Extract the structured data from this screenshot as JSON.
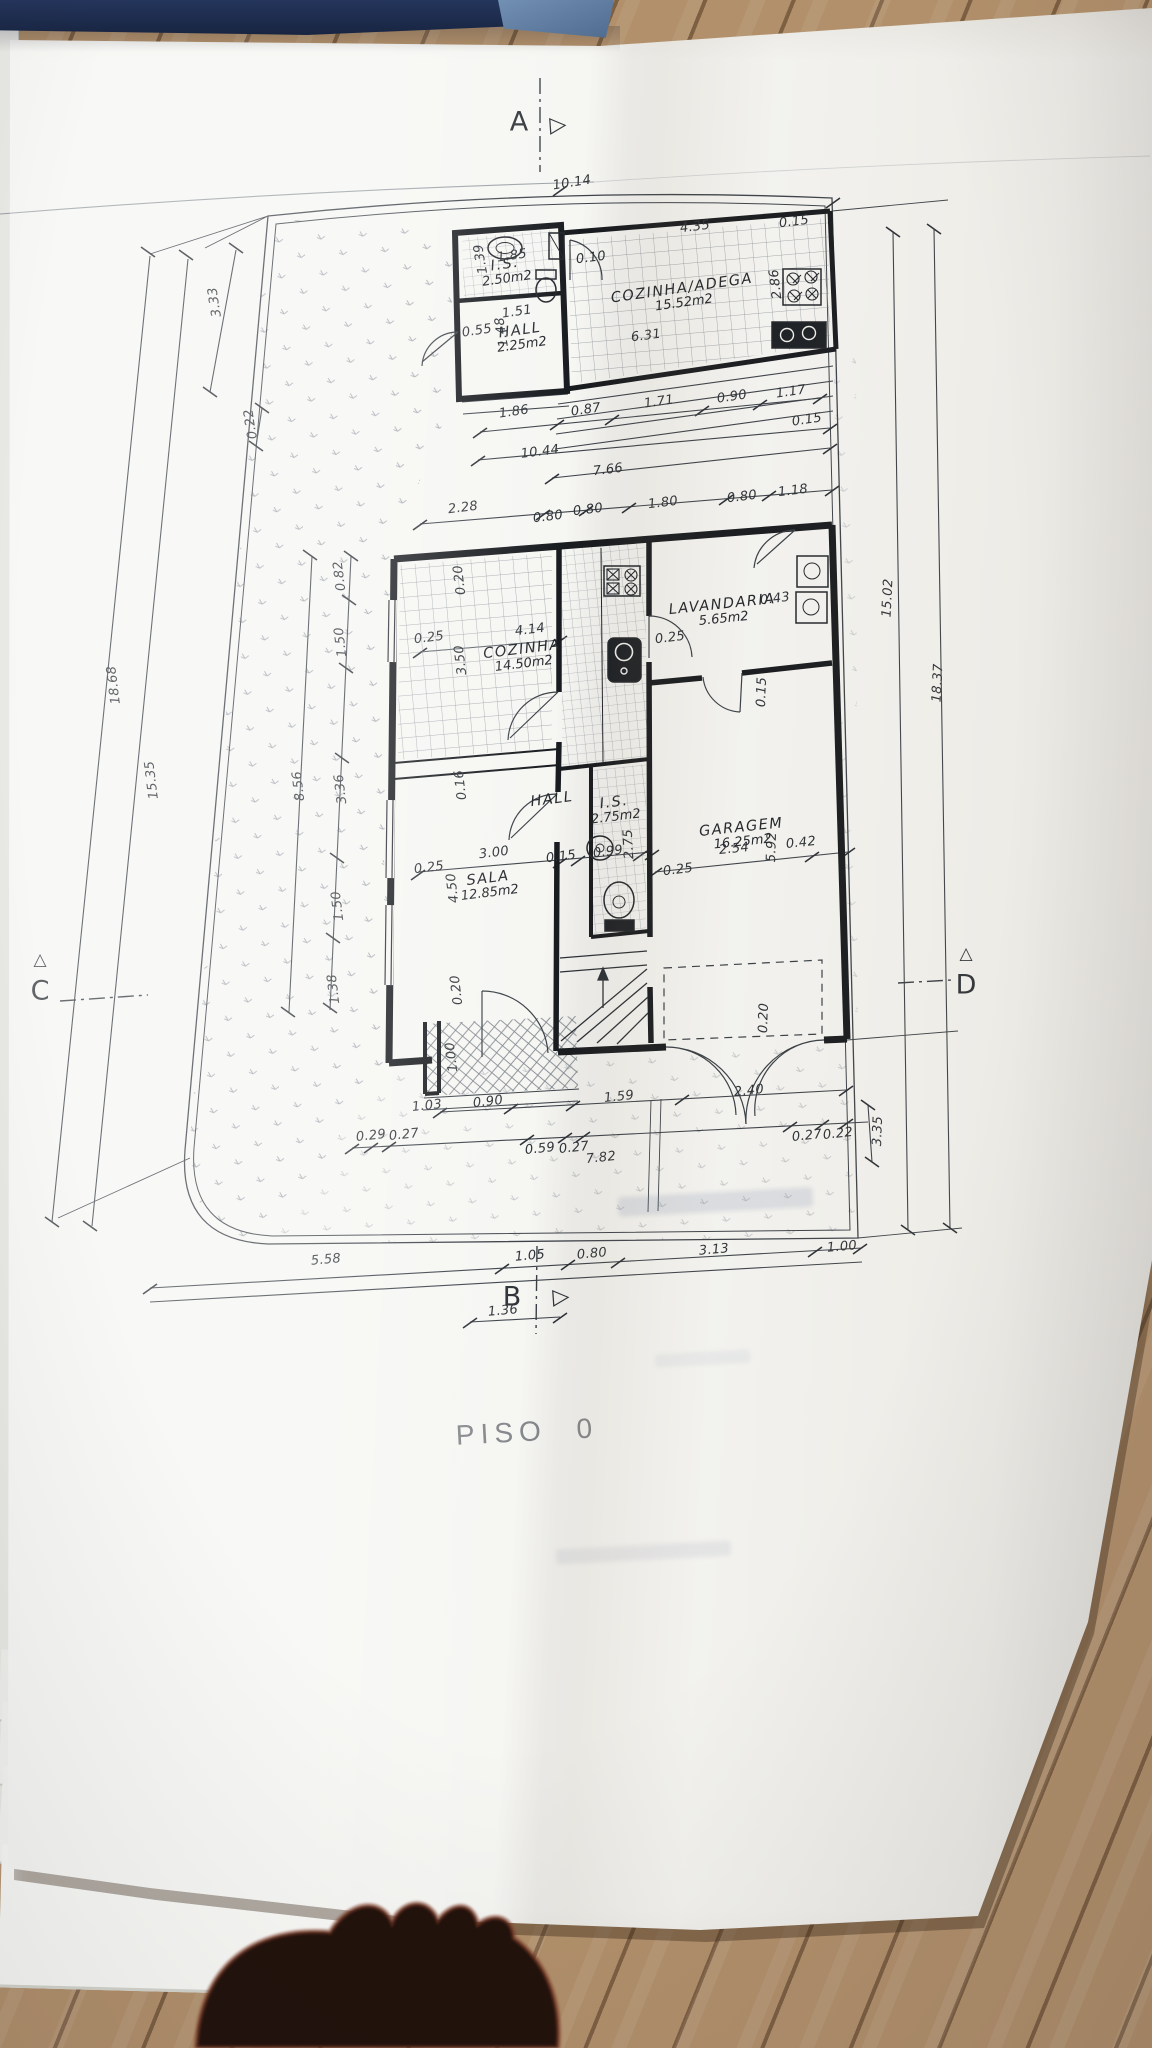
{
  "title": {
    "floor_label": "PISO 0"
  },
  "section_markers": {
    "top": "A",
    "bottom": "B",
    "left": "C",
    "right": "D",
    "right_triangle_glyph": "▷",
    "up_triangle_glyph": "△"
  },
  "rooms": [
    {
      "name": "I.S.",
      "area": "2.50m2",
      "x": 506,
      "y": 272,
      "r": -8
    },
    {
      "name": "HALL",
      "area": "2.25m2",
      "x": 521,
      "y": 338,
      "r": -8
    },
    {
      "name": "COZINHA/ADEGA",
      "area": "15.52m2",
      "x": 683,
      "y": 296,
      "r": -8
    },
    {
      "name": "COZINHA",
      "area": "14.50m2",
      "x": 523,
      "y": 657,
      "r": -7
    },
    {
      "name": "LAVANDARIA",
      "area": "5.65m2",
      "x": 723,
      "y": 612,
      "r": -6
    },
    {
      "name": "HALL",
      "area": "",
      "x": 552,
      "y": 800,
      "r": -7
    },
    {
      "name": "I.S.",
      "area": "2.75m2",
      "x": 615,
      "y": 810,
      "r": -7
    },
    {
      "name": "SALA",
      "area": "12.85m2",
      "x": 489,
      "y": 886,
      "r": -7
    },
    {
      "name": "GARAGEM",
      "area": "16.25m2",
      "x": 742,
      "y": 835,
      "r": -6
    }
  ],
  "dimensions": [
    {
      "t": "10.14",
      "x": 572,
      "y": 183,
      "r": -9
    },
    {
      "t": "4.35",
      "x": 695,
      "y": 227,
      "r": -7
    },
    {
      "t": "0.15",
      "x": 794,
      "y": 222,
      "r": -7
    },
    {
      "t": "2.86",
      "x": 776,
      "y": 284,
      "r": -97
    },
    {
      "t": "0.10",
      "x": 591,
      "y": 258,
      "r": -7
    },
    {
      "t": "1.85",
      "x": 512,
      "y": 256,
      "r": -8
    },
    {
      "t": "1.39",
      "x": 481,
      "y": 259,
      "r": -100
    },
    {
      "t": "1.51",
      "x": 517,
      "y": 312,
      "r": -8
    },
    {
      "t": "0.55",
      "x": 477,
      "y": 331,
      "r": -8
    },
    {
      "t": "1.48",
      "x": 502,
      "y": 332,
      "r": -99
    },
    {
      "t": "6.31",
      "x": 646,
      "y": 336,
      "r": -7
    },
    {
      "t": "1.86",
      "x": 514,
      "y": 412,
      "r": -8
    },
    {
      "t": "0.87",
      "x": 586,
      "y": 410,
      "r": -8
    },
    {
      "t": "1.71",
      "x": 659,
      "y": 402,
      "r": -8
    },
    {
      "t": "0.90",
      "x": 732,
      "y": 397,
      "r": -8
    },
    {
      "t": "1.17",
      "x": 791,
      "y": 392,
      "r": -8
    },
    {
      "t": "0.15",
      "x": 807,
      "y": 420,
      "r": -8
    },
    {
      "t": "10.44",
      "x": 540,
      "y": 452,
      "r": -7
    },
    {
      "t": "7.66",
      "x": 608,
      "y": 470,
      "r": -7
    },
    {
      "t": "2.28",
      "x": 463,
      "y": 508,
      "r": -7
    },
    {
      "t": "0.80",
      "x": 548,
      "y": 517,
      "r": -7
    },
    {
      "t": "0.80",
      "x": 588,
      "y": 510,
      "r": -7
    },
    {
      "t": "1.80",
      "x": 663,
      "y": 503,
      "r": -7
    },
    {
      "t": "0.80",
      "x": 742,
      "y": 497,
      "r": -7
    },
    {
      "t": "1.18",
      "x": 793,
      "y": 491,
      "r": -7
    },
    {
      "t": "3.33",
      "x": 215,
      "y": 302,
      "r": -99
    },
    {
      "t": "0.22",
      "x": 251,
      "y": 424,
      "r": -99
    },
    {
      "t": "18.68",
      "x": 114,
      "y": 685,
      "r": -97
    },
    {
      "t": "15.35",
      "x": 152,
      "y": 780,
      "r": -97
    },
    {
      "t": "8.56",
      "x": 299,
      "y": 786,
      "r": -97
    },
    {
      "t": "0.82",
      "x": 340,
      "y": 576,
      "r": -97
    },
    {
      "t": "1.50",
      "x": 341,
      "y": 642,
      "r": -97
    },
    {
      "t": "3.36",
      "x": 341,
      "y": 789,
      "r": -97
    },
    {
      "t": "1.50",
      "x": 338,
      "y": 906,
      "r": -97
    },
    {
      "t": "1.38",
      "x": 334,
      "y": 989,
      "r": -97
    },
    {
      "t": "0.20",
      "x": 460,
      "y": 580,
      "r": -97
    },
    {
      "t": "4.14",
      "x": 530,
      "y": 630,
      "r": -7
    },
    {
      "t": "0.25",
      "x": 429,
      "y": 638,
      "r": -7
    },
    {
      "t": "3.50",
      "x": 461,
      "y": 660,
      "r": -97
    },
    {
      "t": "0.25",
      "x": 670,
      "y": 638,
      "r": -7
    },
    {
      "t": "0.43",
      "x": 775,
      "y": 599,
      "r": -7
    },
    {
      "t": "0.15",
      "x": 762,
      "y": 692,
      "r": -88
    },
    {
      "t": "0.16",
      "x": 461,
      "y": 785,
      "r": -97
    },
    {
      "t": "3.00",
      "x": 494,
      "y": 853,
      "r": -7
    },
    {
      "t": "0.15",
      "x": 561,
      "y": 857,
      "r": -7
    },
    {
      "t": "0.99",
      "x": 608,
      "y": 852,
      "r": -7
    },
    {
      "t": "2.75",
      "x": 629,
      "y": 844,
      "r": -93
    },
    {
      "t": "0.25",
      "x": 429,
      "y": 868,
      "r": -7
    },
    {
      "t": "0.25",
      "x": 678,
      "y": 870,
      "r": -7
    },
    {
      "t": "4.50",
      "x": 453,
      "y": 888,
      "r": -97
    },
    {
      "t": "2.54",
      "x": 734,
      "y": 849,
      "r": -6
    },
    {
      "t": "5.92",
      "x": 772,
      "y": 847,
      "r": -88
    },
    {
      "t": "0.42",
      "x": 801,
      "y": 843,
      "r": -6
    },
    {
      "t": "0.20",
      "x": 457,
      "y": 990,
      "r": -97
    },
    {
      "t": "1.00",
      "x": 452,
      "y": 1057,
      "r": -97
    },
    {
      "t": "0.20",
      "x": 764,
      "y": 1018,
      "r": -88
    },
    {
      "t": "1.03",
      "x": 427,
      "y": 1106,
      "r": -6
    },
    {
      "t": "0.90",
      "x": 488,
      "y": 1102,
      "r": -6
    },
    {
      "t": "1.59",
      "x": 619,
      "y": 1097,
      "r": -6
    },
    {
      "t": "2.40",
      "x": 749,
      "y": 1091,
      "r": -6
    },
    {
      "t": "0.29",
      "x": 371,
      "y": 1136,
      "r": -6
    },
    {
      "t": "0.27",
      "x": 404,
      "y": 1135,
      "r": -6
    },
    {
      "t": "0.59",
      "x": 540,
      "y": 1149,
      "r": -6
    },
    {
      "t": "0.27",
      "x": 574,
      "y": 1148,
      "r": -6
    },
    {
      "t": "7.82",
      "x": 601,
      "y": 1158,
      "r": -6
    },
    {
      "t": "0.27",
      "x": 807,
      "y": 1136,
      "r": -6
    },
    {
      "t": "0.22",
      "x": 838,
      "y": 1134,
      "r": -6
    },
    {
      "t": "3.35",
      "x": 878,
      "y": 1131,
      "r": -88
    },
    {
      "t": "15.02",
      "x": 888,
      "y": 598,
      "r": -87
    },
    {
      "t": "18.37",
      "x": 938,
      "y": 683,
      "r": -87
    },
    {
      "t": "5.58",
      "x": 326,
      "y": 1260,
      "r": -5
    },
    {
      "t": "1.05",
      "x": 530,
      "y": 1256,
      "r": -5
    },
    {
      "t": "0.80",
      "x": 592,
      "y": 1254,
      "r": -5
    },
    {
      "t": "3.13",
      "x": 714,
      "y": 1250,
      "r": -5
    },
    {
      "t": "1.00",
      "x": 842,
      "y": 1247,
      "r": -5
    },
    {
      "t": "1.36",
      "x": 503,
      "y": 1311,
      "r": -5
    }
  ],
  "colors": {
    "ink": "#2e3338",
    "wall": "#181b1f",
    "paper": "#f6f6f3",
    "navy_band": "#1d2b4e",
    "wood": "#ab8560",
    "title_gray": "#85888c"
  }
}
